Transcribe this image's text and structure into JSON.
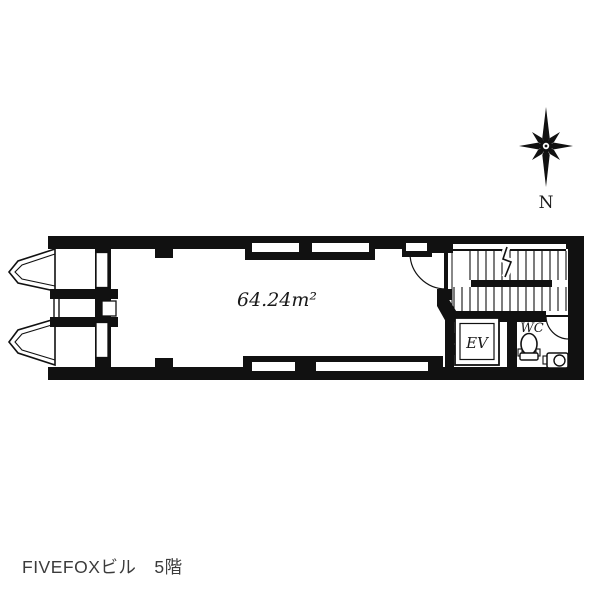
{
  "compass": {
    "label": "N"
  },
  "plan": {
    "area_label": "64.24m²",
    "elevator_label": "EV",
    "toilet_label": "WC"
  },
  "caption": {
    "text": "FIVEFOXビル　5階"
  },
  "colors": {
    "ink": "#111111",
    "caption_text": "#3b3b3b",
    "background": "#ffffff"
  }
}
